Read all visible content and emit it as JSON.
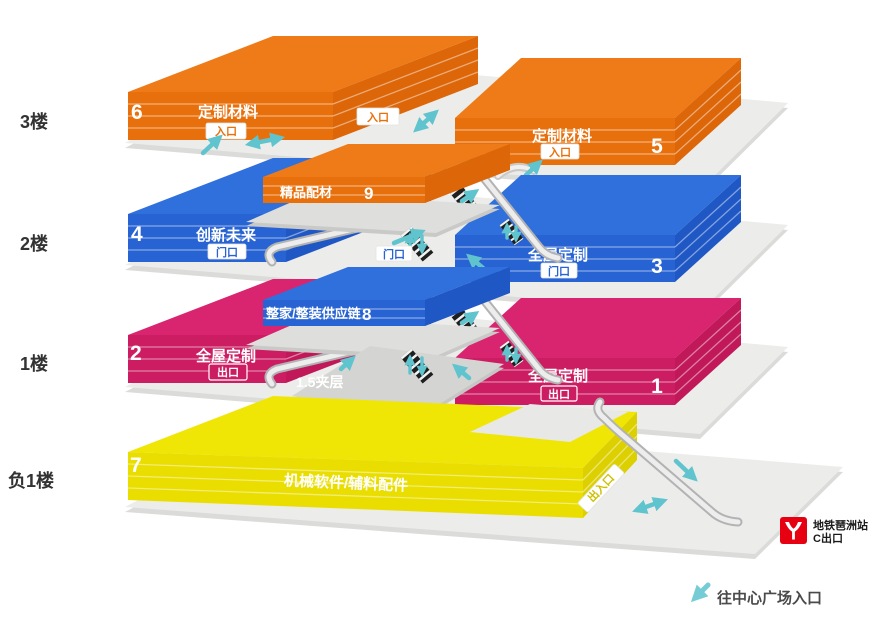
{
  "title": "展馆楼层分布图",
  "floor_labels": {
    "f3": "3楼",
    "f2": "2楼",
    "f1": "1楼",
    "b1": "负1楼"
  },
  "halls": {
    "h6": {
      "num": "6",
      "name": "定制材料",
      "badge": "入口"
    },
    "h5": {
      "num": "5",
      "name": "定制材料",
      "badge": "入口"
    },
    "h9": {
      "num": "9",
      "name": "精品配材"
    },
    "h4": {
      "num": "4",
      "name": "创新未来",
      "badge": "门口"
    },
    "h3": {
      "num": "3",
      "name": "全屋定制",
      "badge": "门口"
    },
    "h8": {
      "num": "8",
      "name": "整家/整装供应链"
    },
    "h2": {
      "num": "2",
      "name": "全屋定制",
      "badge": "出口"
    },
    "h1": {
      "num": "1",
      "name": "全屋定制",
      "badge": "出口"
    },
    "h7": {
      "num": "7",
      "name": "机械软件/辅料配件",
      "badge": "出入口"
    }
  },
  "annotations": {
    "mezzanine": "1.5夹层",
    "entrance_f3": "入口",
    "door_f2": "门口"
  },
  "metro": {
    "station": "地铁琶洲站",
    "exit": "C出口"
  },
  "legend": {
    "to_plaza": "往中心广场入口"
  },
  "colors": {
    "orange": "#E8700C",
    "blue": "#2763D2",
    "magenta": "#CC1D63",
    "yellow": "#E9DE00",
    "teal": "#5FC4CD",
    "metro_red": "#E60012",
    "plate": "#ECECEA"
  }
}
